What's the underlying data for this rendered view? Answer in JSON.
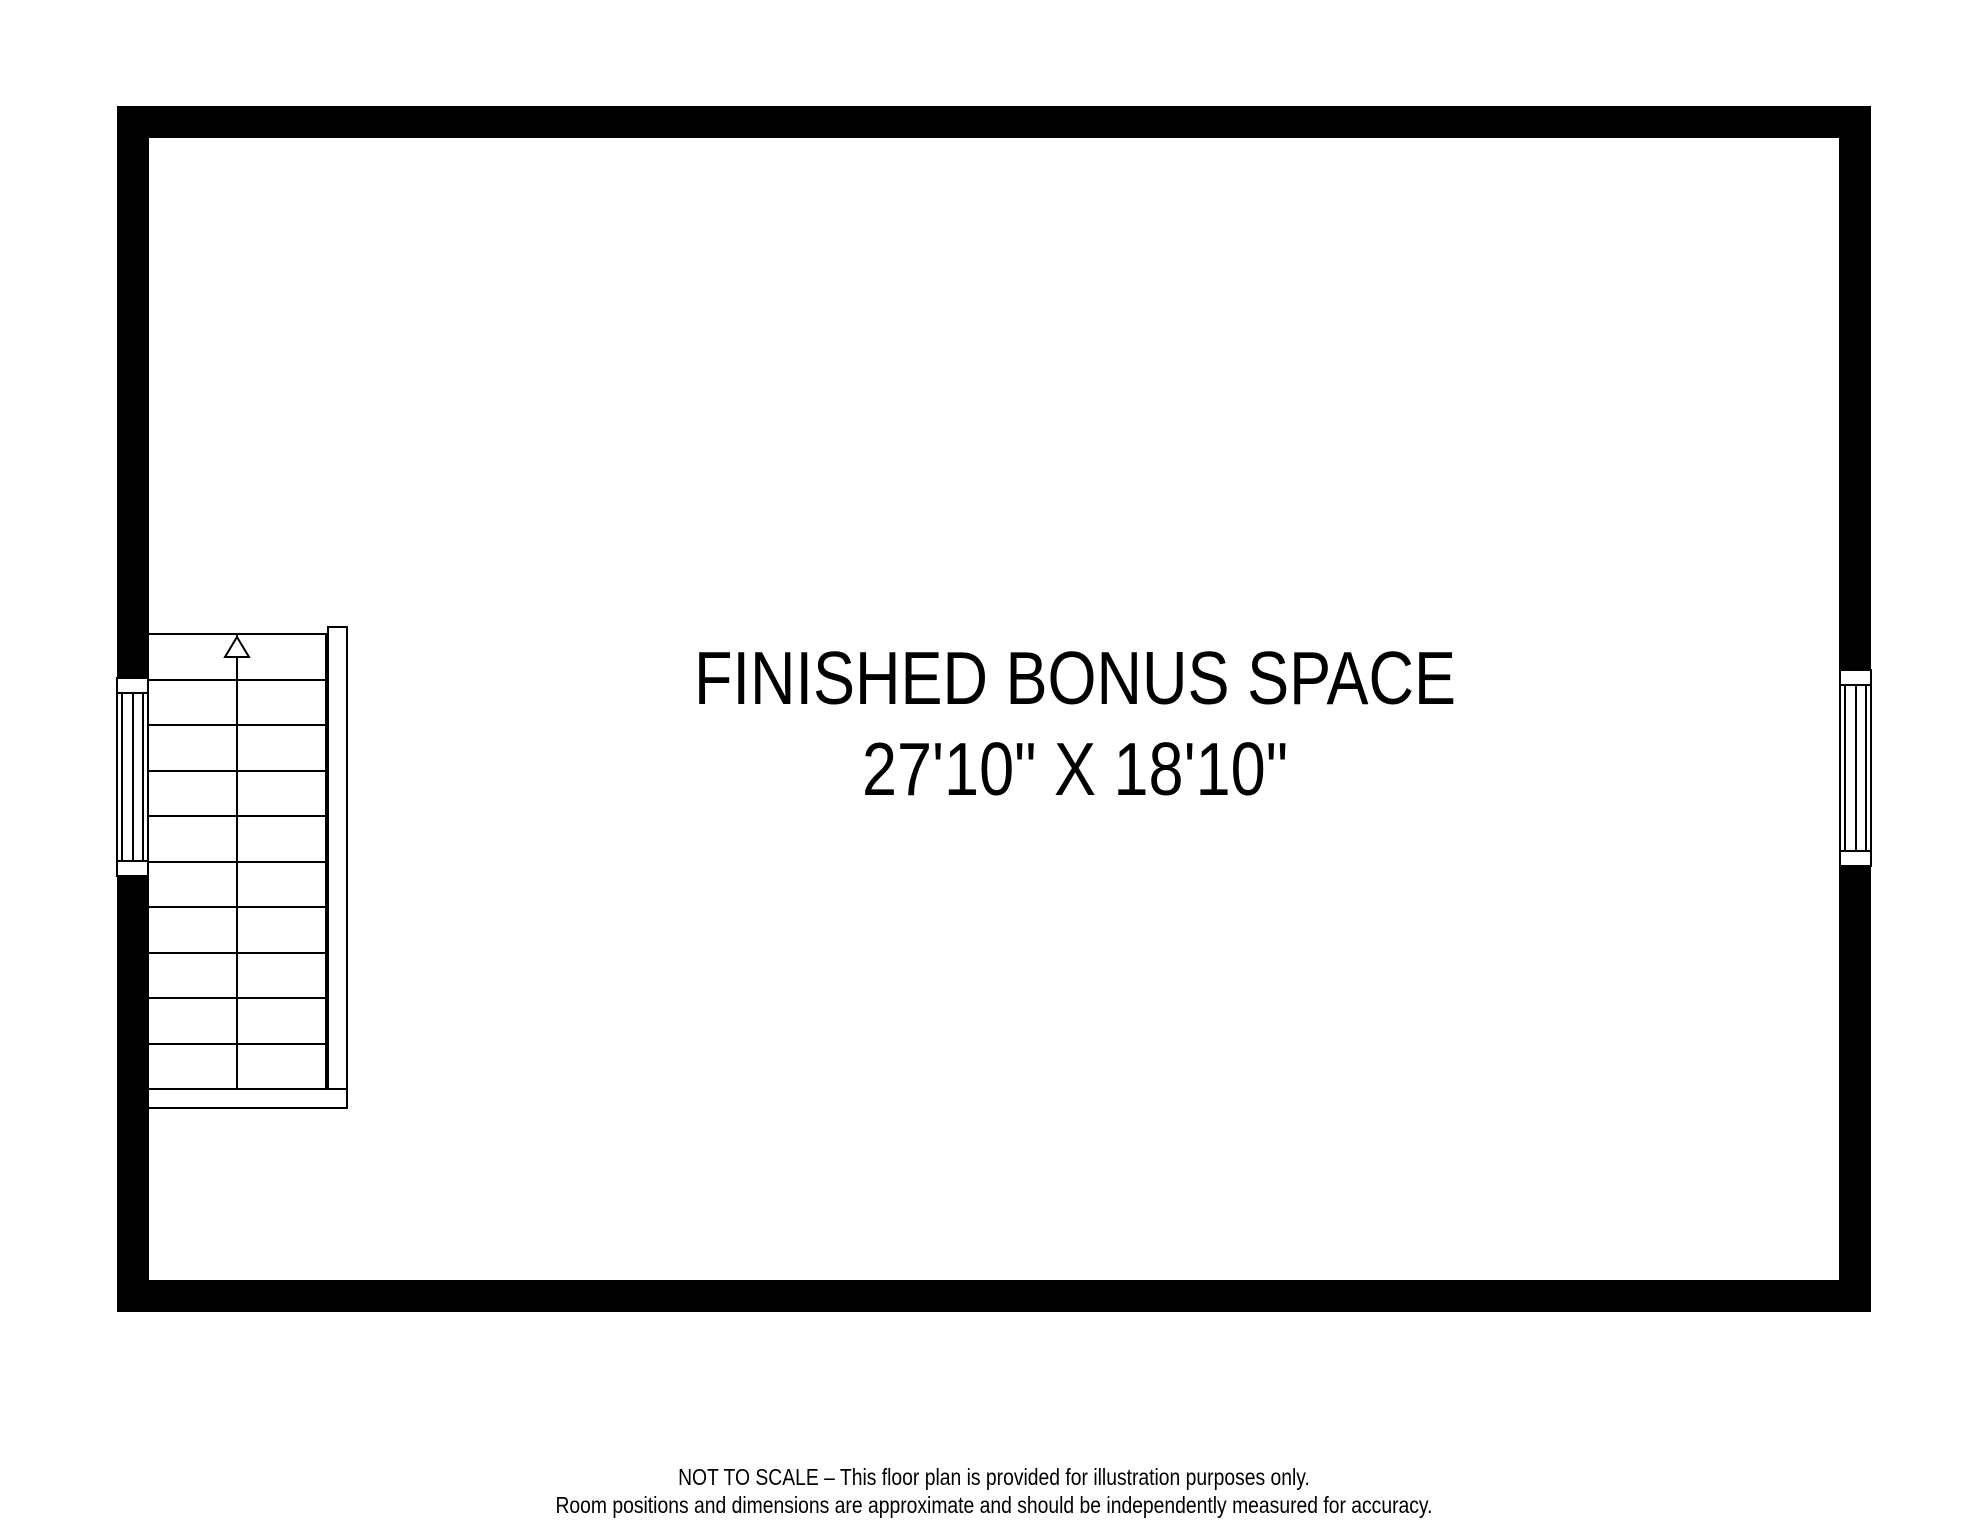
{
  "colors": {
    "wall": "#000000",
    "line": "#000000",
    "background": "#ffffff"
  },
  "room": {
    "name": "FINISHED BONUS SPACE",
    "dimensions": "27'10\" X 18'10\""
  },
  "stairs": {
    "tread_count": 10,
    "direction": "up"
  },
  "windows": [
    {
      "side": "left"
    },
    {
      "side": "right"
    }
  ],
  "disclaimer": {
    "line1": "NOT TO SCALE – This floor plan is provided for illustration purposes only.",
    "line2": "Room positions and dimensions are approximate and should be independently measured for accuracy."
  }
}
